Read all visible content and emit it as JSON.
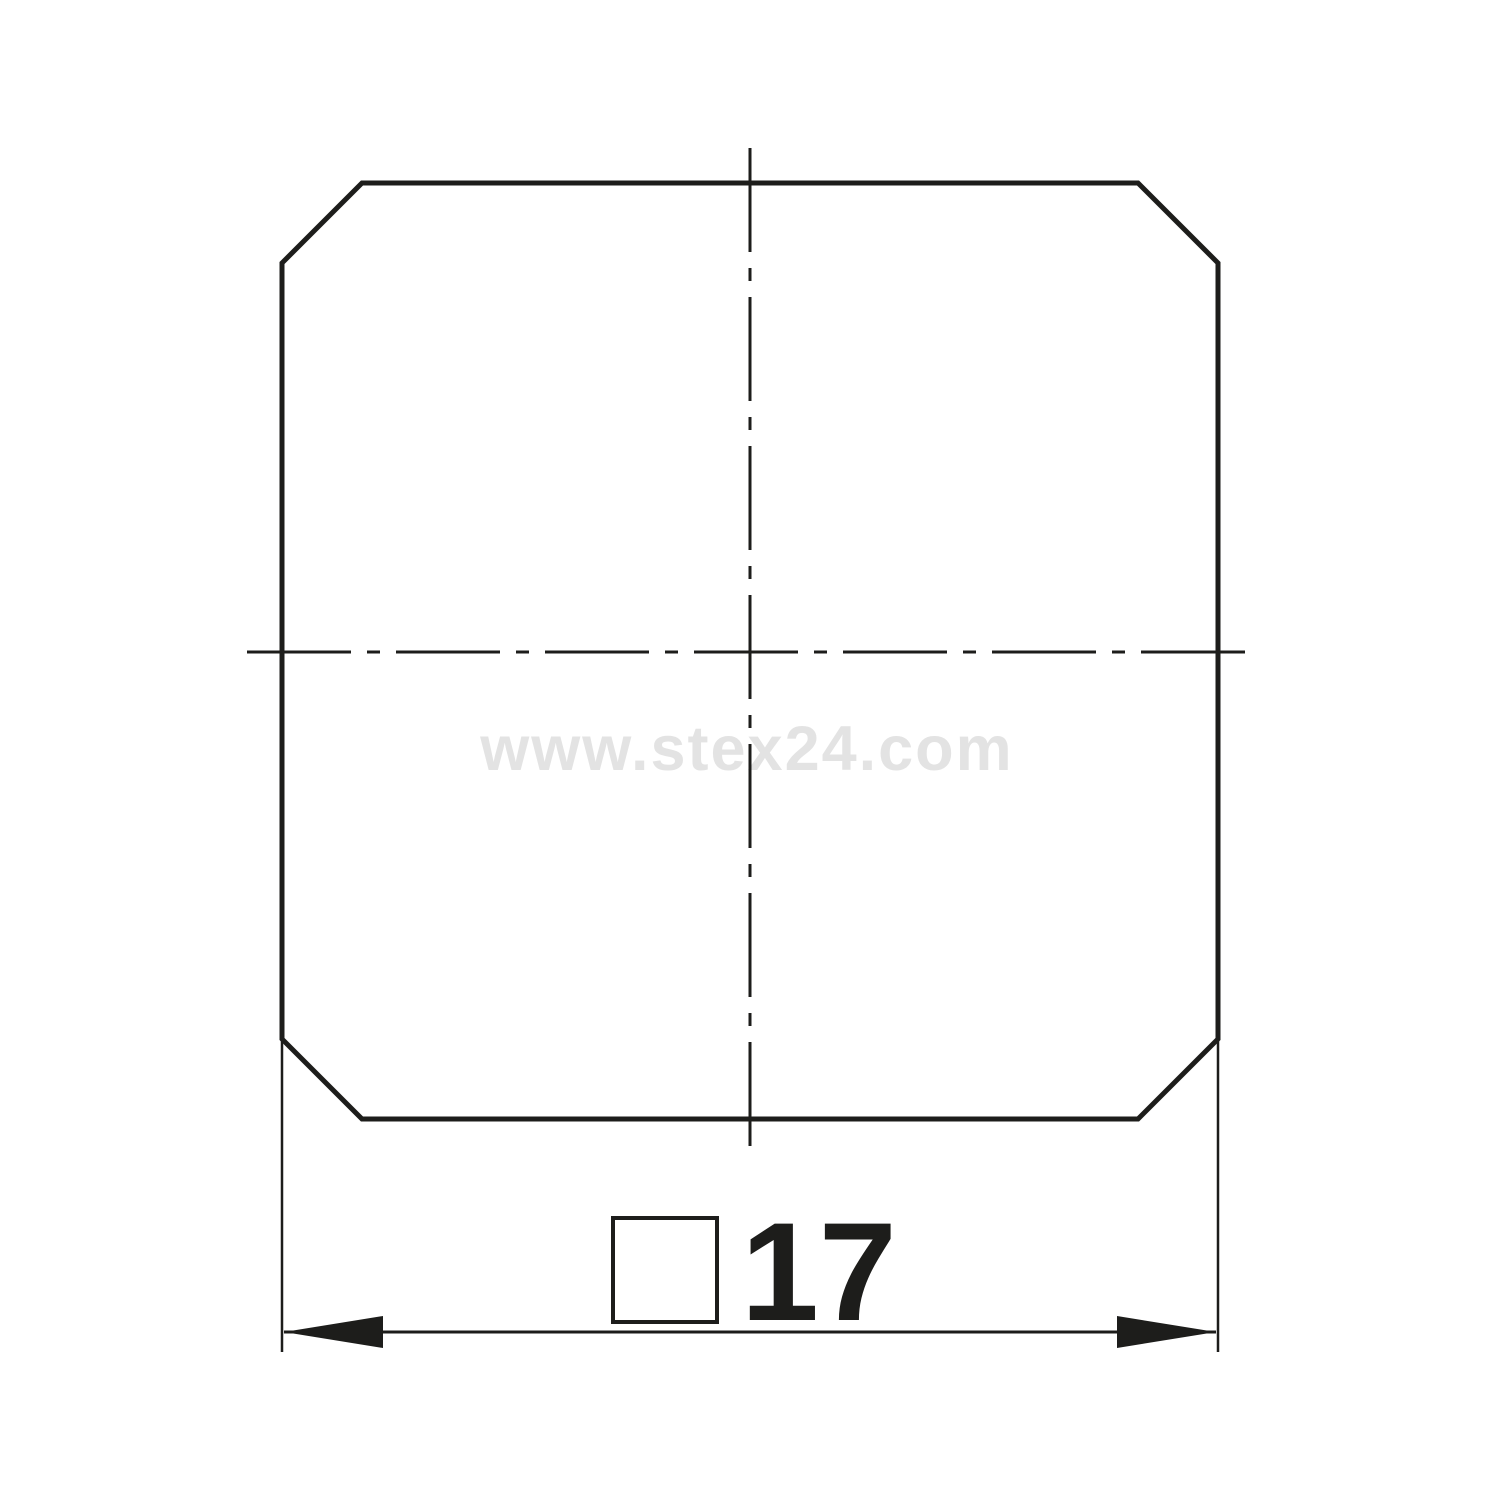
{
  "page": {
    "background": "#ffffff"
  },
  "drawing": {
    "subject": "square profile with chamfered corners, front view",
    "line_color": "#1d1d1b",
    "watermark": {
      "text": "www.stex24.com",
      "color": "#e3e3e3"
    },
    "dimension": {
      "value": "17",
      "symbol": "square-profile",
      "label": "□17"
    }
  }
}
